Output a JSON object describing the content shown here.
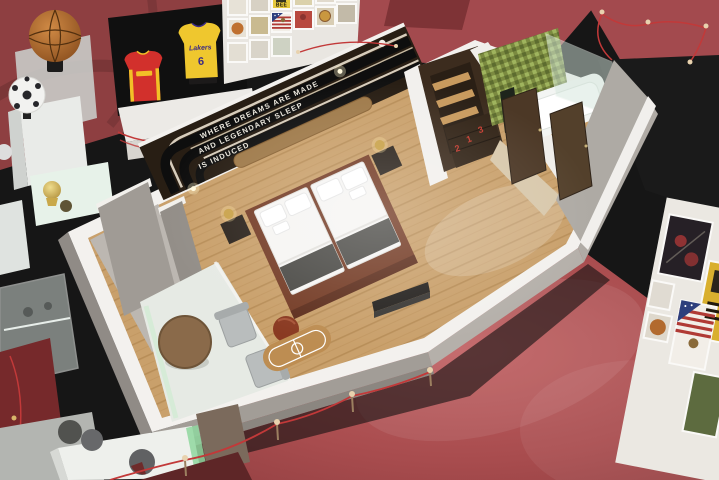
{
  "headboard_wall": {
    "quote_line_1": "WHERE DREAMS ARE MADE",
    "quote_line_2": "AND LEGENDARY SLEEP",
    "quote_line_3": "IS INDUCED"
  },
  "memorabilia": {
    "yellow_jersey_team": "Lakers",
    "yellow_jersey_number": "6",
    "bee_poster_text": "BEE"
  },
  "wardrobe": {
    "drawer_number_a": "2",
    "drawer_number_b": "1",
    "drawer_number_c": "3"
  },
  "colors": {
    "carpet_red": "#a94b4d",
    "carpet_red_dark": "#8e3f41",
    "walkway_black": "#161616",
    "wall_white": "#f3f1ee",
    "concrete_grey": "#a29d97",
    "wood_floor": "#c9a06b",
    "headboard_dark": "#281e14",
    "headboard_bronze": "#9f7a4a",
    "bed_platform": "#753d27",
    "bed_runner": "#4c4b47",
    "bathroom_tile_green": "#7b8a40",
    "jersey_red": "#d2302c",
    "jersey_yellow": "#efc72e",
    "rope_red": "#c23939"
  }
}
